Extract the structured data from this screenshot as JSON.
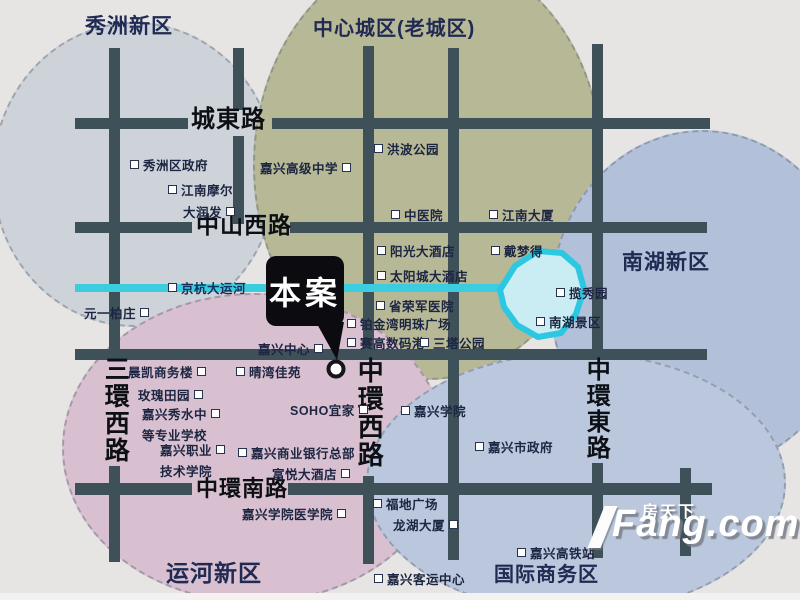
{
  "map": {
    "background": "#e6e5e3",
    "road_color": "#3e5158",
    "river_color": "#3cccdf",
    "lake": {
      "fill": "#c9edf3",
      "stroke": "#2cc7e0",
      "points": "500,290 515,266 538,251 562,253 578,267 584,289 576,314 561,333 538,337 517,325 504,307"
    },
    "districts": [
      {
        "name": "秀洲新区",
        "title": {
          "x": 85,
          "y": 10,
          "size": 21
        },
        "ellipse": {
          "x": -8,
          "y": 22,
          "w": 285,
          "h": 305,
          "fill": "#ced3da"
        }
      },
      {
        "name": "中心城区(老城区)",
        "title": {
          "x": 313,
          "y": 12,
          "size": 20
        },
        "ellipse": {
          "x": 253,
          "y": -50,
          "w": 350,
          "h": 430,
          "fill": "#b7b896"
        }
      },
      {
        "name": "南湖新区",
        "title": {
          "x": 622,
          "y": 246,
          "size": 21
        },
        "ellipse": {
          "x": 550,
          "y": 130,
          "w": 305,
          "h": 340,
          "fill": "#b2c0d9"
        }
      },
      {
        "name": "运河新区",
        "title": {
          "x": 166,
          "y": 554,
          "size": 23
        },
        "ellipse": {
          "x": 62,
          "y": 293,
          "w": 385,
          "h": 310,
          "fill": "#d8c0d0"
        }
      },
      {
        "name": "国际商务区",
        "title": {
          "x": 494,
          "y": 558,
          "size": 20
        },
        "ellipse": {
          "x": 366,
          "y": 352,
          "w": 420,
          "h": 262,
          "fill": "#bac7dc"
        }
      }
    ],
    "road_segments": [
      {
        "x": 75,
        "y": 118,
        "w": 113,
        "h": 11
      },
      {
        "x": 272,
        "y": 118,
        "w": 438,
        "h": 11
      },
      {
        "x": 75,
        "y": 222,
        "w": 117,
        "h": 11
      },
      {
        "x": 290,
        "y": 222,
        "w": 417,
        "h": 11
      },
      {
        "x": 75,
        "y": 349,
        "w": 632,
        "h": 11
      },
      {
        "x": 75,
        "y": 483,
        "w": 117,
        "h": 12
      },
      {
        "x": 288,
        "y": 483,
        "w": 424,
        "h": 12
      },
      {
        "x": 109,
        "y": 48,
        "w": 11,
        "h": 304
      },
      {
        "x": 109,
        "y": 466,
        "w": 11,
        "h": 96
      },
      {
        "x": 233,
        "y": 48,
        "w": 11,
        "h": 62
      },
      {
        "x": 233,
        "y": 136,
        "w": 11,
        "h": 88
      },
      {
        "x": 363,
        "y": 46,
        "w": 11,
        "h": 310
      },
      {
        "x": 363,
        "y": 476,
        "w": 11,
        "h": 88
      },
      {
        "x": 448,
        "y": 48,
        "w": 11,
        "h": 512
      },
      {
        "x": 592,
        "y": 44,
        "w": 11,
        "h": 312
      },
      {
        "x": 592,
        "y": 463,
        "w": 11,
        "h": 95
      },
      {
        "x": 680,
        "y": 468,
        "w": 11,
        "h": 88
      }
    ],
    "road_labels": [
      {
        "text": "城東路",
        "x": 191,
        "y": 107,
        "size": 24,
        "vertical": false
      },
      {
        "text": "中山西路",
        "x": 196,
        "y": 213,
        "size": 23,
        "vertical": false
      },
      {
        "text": "中環南路",
        "x": 196,
        "y": 477,
        "size": 22,
        "vertical": false
      },
      {
        "text": "三環西路",
        "x": 102,
        "y": 356,
        "size": 25,
        "vertical": true
      },
      {
        "text": "中環西路",
        "x": 355,
        "y": 357,
        "size": 26,
        "vertical": true
      },
      {
        "text": "中環東路",
        "x": 583,
        "y": 357,
        "size": 24,
        "vertical": true
      }
    ],
    "river": {
      "x": 75,
      "y": 284,
      "w": 432,
      "h": 8
    },
    "pois": [
      {
        "x": 130,
        "y": 155,
        "lines": [
          {
            "t": "秀洲区政府",
            "m": "l"
          }
        ]
      },
      {
        "x": 168,
        "y": 180,
        "lines": [
          {
            "t": "江南摩尔",
            "m": "l"
          }
        ]
      },
      {
        "x": 183,
        "y": 202,
        "lines": [
          {
            "t": "大润发",
            "m": "r"
          }
        ]
      },
      {
        "x": 260,
        "y": 158,
        "lines": [
          {
            "t": "嘉兴高级中学",
            "m": "r"
          }
        ]
      },
      {
        "x": 374,
        "y": 139,
        "lines": [
          {
            "t": "洪波公园",
            "m": "l"
          }
        ]
      },
      {
        "x": 391,
        "y": 205,
        "lines": [
          {
            "t": "中医院",
            "m": "l"
          }
        ]
      },
      {
        "x": 489,
        "y": 205,
        "lines": [
          {
            "t": "江南大厦",
            "m": "l"
          }
        ]
      },
      {
        "x": 377,
        "y": 241,
        "lines": [
          {
            "t": "阳光大酒店",
            "m": "l"
          }
        ]
      },
      {
        "x": 491,
        "y": 241,
        "lines": [
          {
            "t": "戴梦得",
            "m": "l"
          }
        ]
      },
      {
        "x": 377,
        "y": 266,
        "lines": [
          {
            "t": "太阳城大酒店",
            "m": "l"
          }
        ]
      },
      {
        "x": 376,
        "y": 296,
        "lines": [
          {
            "t": "省荣军医院",
            "m": "l"
          }
        ]
      },
      {
        "x": 347,
        "y": 314,
        "lines": [
          {
            "t": "铂金湾明珠广场",
            "m": "l"
          }
        ]
      },
      {
        "x": 347,
        "y": 333,
        "lines": [
          {
            "t": "赛高数码港",
            "m": "l"
          }
        ]
      },
      {
        "x": 420,
        "y": 333,
        "lines": [
          {
            "t": "三塔公园",
            "m": "l"
          }
        ]
      },
      {
        "x": 168,
        "y": 278,
        "river": true,
        "lines": [
          {
            "t": "京杭大运河",
            "m": "l"
          }
        ]
      },
      {
        "x": 84,
        "y": 303,
        "lines": [
          {
            "t": "元一柏庄",
            "m": "r"
          }
        ]
      },
      {
        "x": 258,
        "y": 339,
        "lines": [
          {
            "t": "嘉兴中心",
            "m": "r"
          }
        ]
      },
      {
        "x": 556,
        "y": 283,
        "lines": [
          {
            "t": "揽秀园",
            "m": "l"
          }
        ]
      },
      {
        "x": 536,
        "y": 312,
        "lines": [
          {
            "t": "南湖景区",
            "m": "l"
          }
        ]
      },
      {
        "x": 128,
        "y": 362,
        "lines": [
          {
            "t": "晨凯商务楼",
            "m": "r"
          }
        ]
      },
      {
        "x": 236,
        "y": 362,
        "lines": [
          {
            "t": "晴湾佳苑",
            "m": "l"
          }
        ]
      },
      {
        "x": 138,
        "y": 385,
        "lines": [
          {
            "t": "玫瑰田园",
            "m": "r"
          }
        ]
      },
      {
        "x": 142,
        "y": 404,
        "lines": [
          {
            "t": "嘉兴秀水中",
            "m": "r"
          },
          {
            "t": "等专业学校",
            "m": ""
          }
        ]
      },
      {
        "x": 160,
        "y": 440,
        "lines": [
          {
            "t": "嘉兴职业",
            "m": "r"
          },
          {
            "t": "技术学院",
            "m": ""
          }
        ]
      },
      {
        "x": 290,
        "y": 400,
        "lines": [
          {
            "t": "SOHO宜家",
            "m": "r"
          }
        ]
      },
      {
        "x": 238,
        "y": 443,
        "lines": [
          {
            "t": "嘉兴商业银行总部",
            "m": "l"
          },
          {
            "t": "富悦大酒店",
            "m": "r",
            "indent": 34
          }
        ]
      },
      {
        "x": 242,
        "y": 504,
        "lines": [
          {
            "t": "嘉兴学院医学院",
            "m": "r"
          }
        ]
      },
      {
        "x": 401,
        "y": 401,
        "lines": [
          {
            "t": "嘉兴学院",
            "m": "l"
          }
        ]
      },
      {
        "x": 475,
        "y": 437,
        "lines": [
          {
            "t": "嘉兴市政府",
            "m": "l"
          }
        ]
      },
      {
        "x": 373,
        "y": 494,
        "lines": [
          {
            "t": "福地广场",
            "m": "l"
          },
          {
            "t": "龙湖大厦",
            "m": "r",
            "indent": 20
          }
        ]
      },
      {
        "x": 517,
        "y": 543,
        "lines": [
          {
            "t": "嘉兴高铁站",
            "m": "l"
          }
        ]
      },
      {
        "x": 374,
        "y": 569,
        "lines": [
          {
            "t": "嘉兴客运中心",
            "m": "l"
          }
        ]
      }
    ],
    "callout": {
      "label": "本案",
      "box": {
        "x": 266,
        "y": 256,
        "w": 78,
        "h": 70,
        "font": 32
      },
      "tail": "316,322 344,322 337,360",
      "circle": {
        "cx": 336,
        "cy": 369,
        "r": 7.5
      }
    },
    "watermark": {
      "cn": "房天下",
      "en": "Fang.com"
    }
  }
}
